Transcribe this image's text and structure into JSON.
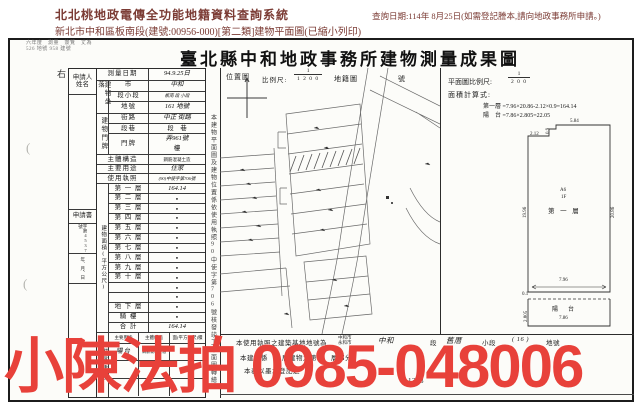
{
  "header": {
    "system_title": "北北桃地政電傳全功能地籍資料查詢系統",
    "query_date": "查詢日期:114年 8月25日(如需登記謄本,請向地政事務所申請。)",
    "doc_line": "新北市中和區板南段(建號:00956-000)[第二類]建物平面圖(已縮小列印)"
  },
  "document": {
    "stamp_line1": "六年度　測量　簽覽　丈為",
    "stamp_line2": "526 地號 958 建號",
    "title": "臺北縣中和地政事務所建物測量成果圖",
    "margin_char": "右",
    "paren_mark": "("
  },
  "applicant": {
    "header1": "申請人",
    "header2": "姓名",
    "book": "申請書",
    "no": "字第4537號",
    "date": "年、月、日"
  },
  "form": {
    "survey_date_label": "測量日期",
    "survey_date_value": "94.9.25日",
    "location_group": "建物坐落",
    "city_label": "市",
    "city_value": "中和",
    "section_label": "段小段",
    "section_value": "板南 段 小段",
    "parcel_label": "地號",
    "parcel_value": "161 地號",
    "address_group": "建物門牌",
    "street_label": "街路",
    "street_value": "中正 街路",
    "lane_label": "段巷",
    "lane_value": "段　巷",
    "door_label": "門牌",
    "door_value": "弄961號",
    "floor_suffix": "樓",
    "structure_label": "主體構造",
    "structure_value": "鋼筋混凝土造",
    "use_label": "主要用途",
    "use_value": "住家",
    "license_label": "使用執照",
    "license_value": "(90)中使字第706號",
    "area_group": "建物面積(平方公尺)",
    "floors": [
      {
        "label": "第 一 層",
        "value": "164.14"
      },
      {
        "label": "第 二 層",
        "value": "●"
      },
      {
        "label": "第 三 層",
        "value": "●"
      },
      {
        "label": "第 四 層",
        "value": "●"
      },
      {
        "label": "第 五 層",
        "value": "●"
      },
      {
        "label": "第 六 層",
        "value": "●"
      },
      {
        "label": "第 七 層",
        "value": "●"
      },
      {
        "label": "第 八 層",
        "value": "●"
      },
      {
        "label": "第 九 層",
        "value": "●"
      },
      {
        "label": "第 十 層",
        "value": "●"
      },
      {
        "label": "",
        "value": "●"
      },
      {
        "label": "",
        "value": "●"
      },
      {
        "label": "地 下 層",
        "value": "●"
      },
      {
        "label": "騎 樓",
        "value": "●"
      },
      {
        "label": "合 計",
        "value": "164.14"
      }
    ],
    "annex_group": "附屬建物",
    "annex_headers": [
      "主要用途",
      "主體構造",
      "面(平方公尺)積"
    ],
    "annex_rows": [
      {
        "use": "陽台",
        "structure": "鋼筋混凝土造",
        "area": ""
      },
      {
        "use": "",
        "structure": "",
        "area": "22.05"
      },
      {
        "use": "",
        "structure": "",
        "area": ""
      }
    ]
  },
  "middle": {
    "location_map_label": "位置圖",
    "scale_label": "比例尺:",
    "scale_num": "1",
    "scale_den": "1 2 0 0",
    "cadastral_label": "地籍圖",
    "sheet_label": "號",
    "note_vertical": "本建物平面圖及建物位置係依使用執照90中使字第706號核發竣工平面圖轉繪",
    "bottom_line1_prefix": "本使用執照之建築基地地號為",
    "bottom_line1_opt1": "中和市",
    "bottom_line1_opt2": "永和市",
    "bottom_line1_fill1": "中和",
    "bottom_line1_seg": "段",
    "bottom_line1_fill2": "舊厝",
    "bottom_line1_subseg": "小段",
    "bottom_line1_parcel": "( 16 )",
    "bottom_line1_suffix": "地號",
    "bottom_line2": "本建物係　　層建物之第　　層部分",
    "bottom_line3": "本表以墨水登記之",
    "bottom_number": "1383"
  },
  "plan": {
    "scale_label": "平面圖比例尺:",
    "scale_num": "1",
    "scale_den": "2 0 0",
    "calc_label": "面積計算式:",
    "calc_line1": "第一層 =7.96×20.86-2.12×0.9=164.14",
    "calc_line2": "陽　台 =7.86×2.805=22.05",
    "dims": {
      "top_left": "2.12",
      "notch": "0.9",
      "top": "5.84",
      "left": "19.96",
      "right": "20.86",
      "unit": "A6",
      "floor_tag": "1F",
      "room": "第 一 層",
      "bottom": "7.96",
      "gap": "0.1",
      "balcony": "陽　台",
      "balcony_width": "7.86",
      "balcony_depth": "2.805"
    }
  },
  "overlay": {
    "watermark": "小陳法拍 0985-048006",
    "color": "#e8413a"
  }
}
